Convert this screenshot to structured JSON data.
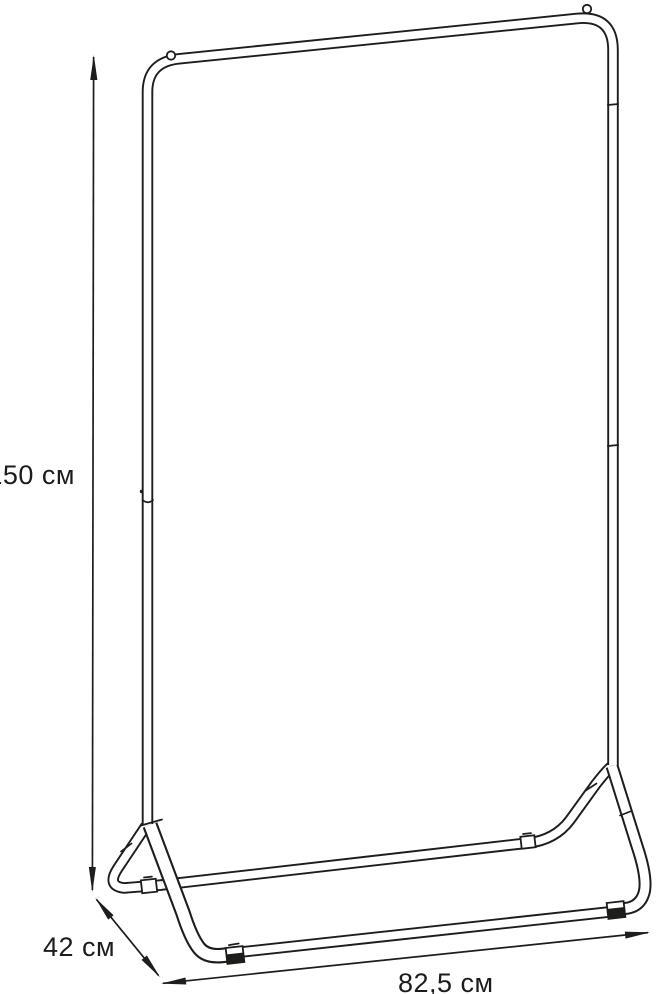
{
  "diagram": {
    "type": "product-dimension-drawing",
    "subject": "garment-rack",
    "background_color": "#ffffff",
    "line_color": "#1d1d1b",
    "dimensions": {
      "height": {
        "label": "150 см",
        "value": 150,
        "unit": "см"
      },
      "depth": {
        "label": "42 см",
        "value": 42,
        "unit": "см"
      },
      "width": {
        "label": "82,5 см",
        "value": 82.5,
        "unit": "см"
      }
    }
  }
}
